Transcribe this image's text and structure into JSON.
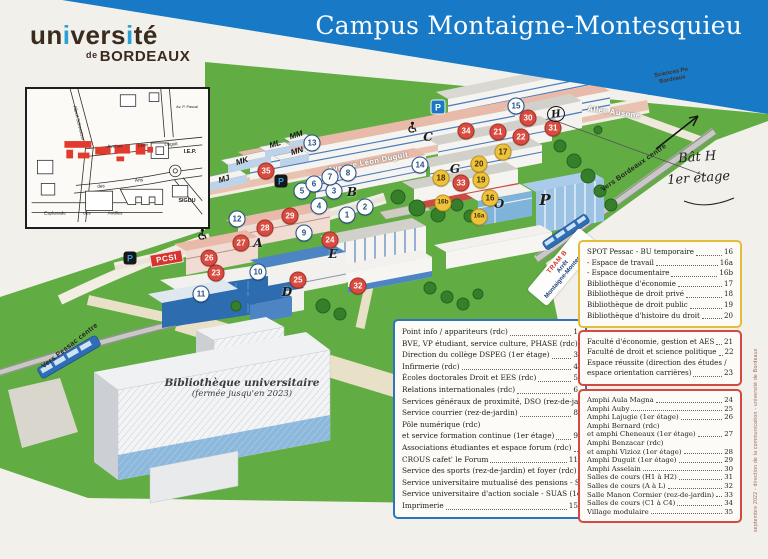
{
  "header": {
    "title": "Campus Montaigne-Montesquieu"
  },
  "logo": {
    "u1": "un",
    "i1": "i",
    "u2": "vers",
    "i2": "i",
    "u3": "té",
    "de": "de",
    "bordeaux": "BORDEAUX"
  },
  "credit": "septembre 2022 - direction de la communication - université de Bordeaux",
  "inset": {
    "labels": [
      {
        "t": "Albert Schweitzer",
        "x": 52,
        "y": 34,
        "rot": 76,
        "cls": "ins"
      },
      {
        "t": "Avenue",
        "x": 88,
        "y": 57,
        "rot": -3,
        "cls": "ins"
      },
      {
        "t": "Léon",
        "x": 116,
        "y": 56,
        "rot": -3,
        "cls": "ins"
      },
      {
        "t": "Duguit",
        "x": 144,
        "y": 55,
        "rot": -3,
        "cls": "ins"
      },
      {
        "t": "Av. P. Pascal",
        "x": 160,
        "y": 18,
        "rot": 0,
        "cls": "instiny"
      },
      {
        "t": "des",
        "x": 74,
        "y": 97,
        "rot": -4,
        "cls": "ins"
      },
      {
        "t": "Arts",
        "x": 112,
        "y": 91,
        "rot": -4,
        "cls": "ins"
      },
      {
        "t": "I.E.P.",
        "x": 163,
        "y": 63,
        "rot": 0,
        "cls": "insbold"
      },
      {
        "t": "SIGDU",
        "x": 160,
        "y": 112,
        "rot": 0,
        "cls": "insbold"
      },
      {
        "t": "Esplanade",
        "x": 28,
        "y": 124,
        "rot": 0,
        "cls": "ins"
      },
      {
        "t": "des",
        "x": 60,
        "y": 124,
        "rot": 0,
        "cls": "ins"
      },
      {
        "t": "Antilles",
        "x": 88,
        "y": 124,
        "rot": 0,
        "cls": "ins"
      }
    ]
  },
  "map": {
    "pcsi": "PCSI",
    "circled_h": "H",
    "tram_stop": {
      "l1": "TRAM B",
      "l2": "Arrêt",
      "l3": "Montaigne-Montesquieu"
    },
    "sciences_po": {
      "l1": "Sciences Po",
      "l2": "Bordeaux"
    },
    "bu": {
      "l1": "Bibliothèque universitaire",
      "l2": "(fermée jusqu'en 2023)"
    },
    "handwriting": {
      "l1": "Bât H",
      "l2": "1er étage"
    },
    "street_labels": [
      {
        "t": "Avenue Léon Duguit",
        "x": 368,
        "y": 162,
        "rot": -11,
        "cls": "street-white"
      },
      {
        "t": "Allée Ausone",
        "x": 614,
        "y": 112,
        "rot": 8,
        "cls": "street-white"
      },
      {
        "t": "Vers Bordeaux centre",
        "x": 634,
        "y": 168,
        "rot": -35,
        "cls": "dir-label"
      },
      {
        "t": "Vers Pessac centre",
        "x": 70,
        "y": 346,
        "rot": -38,
        "cls": "dir-label"
      }
    ],
    "letters": [
      {
        "t": "A",
        "x": 258,
        "y": 243
      },
      {
        "t": "B",
        "x": 352,
        "y": 192
      },
      {
        "t": "C",
        "x": 428,
        "y": 137
      },
      {
        "t": "D",
        "x": 287,
        "y": 292
      },
      {
        "t": "E",
        "x": 333,
        "y": 254
      },
      {
        "t": "G",
        "x": 455,
        "y": 169
      },
      {
        "t": "O",
        "x": 499,
        "y": 204
      },
      {
        "t": "P",
        "x": 545,
        "y": 200,
        "cls": "big"
      }
    ],
    "modules": [
      {
        "t": "MJ",
        "x": 224,
        "y": 179,
        "rot": -17
      },
      {
        "t": "MK",
        "x": 242,
        "y": 161,
        "rot": -17
      },
      {
        "t": "ML",
        "x": 275,
        "y": 144,
        "rot": -17
      },
      {
        "t": "MM",
        "x": 296,
        "y": 135,
        "rot": -17
      },
      {
        "t": "MN",
        "x": 297,
        "y": 151,
        "rot": -17
      }
    ],
    "markers": [
      {
        "n": "1",
        "x": 347,
        "y": 215,
        "cls": "m-white"
      },
      {
        "n": "2",
        "x": 365,
        "y": 207,
        "cls": "m-white"
      },
      {
        "n": "3",
        "x": 334,
        "y": 191,
        "cls": "m-white"
      },
      {
        "n": "4",
        "x": 319,
        "y": 206,
        "cls": "m-white"
      },
      {
        "n": "5",
        "x": 302,
        "y": 191,
        "cls": "m-white"
      },
      {
        "n": "6",
        "x": 314,
        "y": 184,
        "cls": "m-white"
      },
      {
        "n": "7",
        "x": 330,
        "y": 177,
        "cls": "m-white"
      },
      {
        "n": "8",
        "x": 348,
        "y": 173,
        "cls": "m-white"
      },
      {
        "n": "9",
        "x": 304,
        "y": 233,
        "cls": "m-white"
      },
      {
        "n": "10",
        "x": 258,
        "y": 272,
        "cls": "m-white"
      },
      {
        "n": "11",
        "x": 201,
        "y": 294,
        "cls": "m-white"
      },
      {
        "n": "12",
        "x": 237,
        "y": 219,
        "cls": "m-white"
      },
      {
        "n": "13",
        "x": 312,
        "y": 143,
        "cls": "m-white"
      },
      {
        "n": "14",
        "x": 420,
        "y": 165,
        "cls": "m-white"
      },
      {
        "n": "15",
        "x": 516,
        "y": 106,
        "cls": "m-white"
      },
      {
        "n": "16",
        "x": 490,
        "y": 198,
        "cls": "m-yellow"
      },
      {
        "n": "16a",
        "x": 479,
        "y": 217,
        "cls": "m-yellow m-small"
      },
      {
        "n": "16b",
        "x": 443,
        "y": 203,
        "cls": "m-yellow m-small"
      },
      {
        "n": "17",
        "x": 503,
        "y": 152,
        "cls": "m-yellow"
      },
      {
        "n": "18",
        "x": 441,
        "y": 178,
        "cls": "m-yellow"
      },
      {
        "n": "19",
        "x": 481,
        "y": 180,
        "cls": "m-yellow"
      },
      {
        "n": "20",
        "x": 479,
        "y": 164,
        "cls": "m-yellow"
      },
      {
        "n": "21",
        "x": 498,
        "y": 132,
        "cls": "m-red"
      },
      {
        "n": "22",
        "x": 521,
        "y": 137,
        "cls": "m-red"
      },
      {
        "n": "23",
        "x": 216,
        "y": 273,
        "cls": "m-red"
      },
      {
        "n": "24",
        "x": 330,
        "y": 240,
        "cls": "m-red"
      },
      {
        "n": "25",
        "x": 298,
        "y": 280,
        "cls": "m-red"
      },
      {
        "n": "26",
        "x": 209,
        "y": 258,
        "cls": "m-red"
      },
      {
        "n": "27",
        "x": 241,
        "y": 243,
        "cls": "m-red"
      },
      {
        "n": "28",
        "x": 265,
        "y": 228,
        "cls": "m-red"
      },
      {
        "n": "29",
        "x": 290,
        "y": 216,
        "cls": "m-red"
      },
      {
        "n": "30",
        "x": 528,
        "y": 118,
        "cls": "m-red"
      },
      {
        "n": "31",
        "x": 553,
        "y": 128,
        "cls": "m-red"
      },
      {
        "n": "32",
        "x": 358,
        "y": 286,
        "cls": "m-red"
      },
      {
        "n": "33",
        "x": 461,
        "y": 183,
        "cls": "m-red"
      },
      {
        "n": "34",
        "x": 466,
        "y": 131,
        "cls": "m-red"
      },
      {
        "n": "35",
        "x": 266,
        "y": 171,
        "cls": "m-red"
      }
    ],
    "parkings": [
      {
        "t": "P",
        "x": 438,
        "y": 107,
        "cls": "park-blue"
      },
      {
        "t": "P",
        "x": 281,
        "y": 181,
        "cls": "park-dark"
      },
      {
        "t": "P",
        "x": 130,
        "y": 258,
        "cls": "park-dark"
      }
    ],
    "wheelchairs": [
      {
        "x": 412,
        "y": 125
      },
      {
        "x": 202,
        "y": 232
      }
    ]
  },
  "legends": {
    "services": {
      "rows": [
        {
          "label": "Point info / appariteurs (rdc)",
          "num": "1"
        },
        {
          "label": "BVE, VP étudiant, service culture, PHASE (rdc)",
          "num": "2"
        },
        {
          "label": "Direction du collège DSPEG (1er étage)",
          "num": "3"
        },
        {
          "label": "Infirmerie (rdc)",
          "num": "4"
        },
        {
          "label": "Écoles doctorales Droit et EES (rdc)",
          "num": "5"
        },
        {
          "label": "Relations internationales (rdc)",
          "num": "6"
        },
        {
          "label": "Services généraux de proximité, DSO (rez-de-jardin)",
          "num": "7"
        },
        {
          "label": "Service courrier (rez-de-jardin)",
          "num": "8"
        },
        {
          "label": "Pôle numérique (rdc)",
          "num": "",
          "cls": "nonum"
        },
        {
          "label": "et service formation continue (1er étage)",
          "num": "9"
        },
        {
          "label": "Associations étudiantes et espace forum (rdc)",
          "num": "10"
        },
        {
          "label": "CROUS cafet' le Forum",
          "num": "11"
        },
        {
          "label": "Service des sports (rez-de-jardin) et foyer (rdc)",
          "num": "12"
        },
        {
          "label": "Service universitaire mutualisé des pensions - SUMP",
          "num": "13"
        },
        {
          "label": "Service universitaire d'action sociale - SUAS (1er étage)",
          "num": "14"
        },
        {
          "label": "Imprimerie",
          "num": "15"
        }
      ]
    },
    "libraries": {
      "rows": [
        {
          "label": "SPOT Pessac - BU temporaire",
          "num": "16"
        },
        {
          "label": "- Espace de travail",
          "num": "16a"
        },
        {
          "label": "- Espace documentaire",
          "num": "16b"
        },
        {
          "label": "Bibliothèque d'économie",
          "num": "17"
        },
        {
          "label": "Bibliothèque de droit privé",
          "num": "18"
        },
        {
          "label": "Bibliothèque de droit public",
          "num": "19"
        },
        {
          "label": "Bibliothèque d'histoire du droit",
          "num": "20"
        }
      ]
    },
    "faculties": {
      "rows": [
        {
          "label": "Faculté d'économie, gestion et AES",
          "num": "21"
        },
        {
          "label": "Faculté de droit et science politique",
          "num": "22"
        },
        {
          "label": "Espace réussite (direction des études /",
          "num": "",
          "cls": "nonum"
        },
        {
          "label": "espace orientation carrières)",
          "num": "23"
        }
      ]
    },
    "amphis": {
      "rows": [
        {
          "label": "Amphi Aula Magna",
          "num": "24"
        },
        {
          "label": "Amphi Auby",
          "num": "25"
        },
        {
          "label": "Amphi Lajugie (1er étage)",
          "num": "26"
        },
        {
          "label": "Amphi Bernard (rdc)",
          "num": "",
          "cls": "nonum"
        },
        {
          "label": "et amphi Cheneaux (1er étage)",
          "num": "27"
        },
        {
          "label": "Amphi Benzacar (rdc)",
          "num": "",
          "cls": "nonum"
        },
        {
          "label": "et amphi Vizioz (1er étage)",
          "num": "28"
        },
        {
          "label": "Amphi Duguit (1er étage)",
          "num": "29"
        },
        {
          "label": "Amphi Asselain",
          "num": "30"
        },
        {
          "label": "Salles de cours (H1 à H2)",
          "num": "31"
        },
        {
          "label": "Salles de cours (A à L)",
          "num": "32"
        },
        {
          "label": "Salle Manon Cormier (rez-de-jardin)",
          "num": "33"
        },
        {
          "label": "Salles de cours (C1 à C4)",
          "num": "34"
        },
        {
          "label": "Village modulaire",
          "num": "35"
        }
      ]
    }
  }
}
